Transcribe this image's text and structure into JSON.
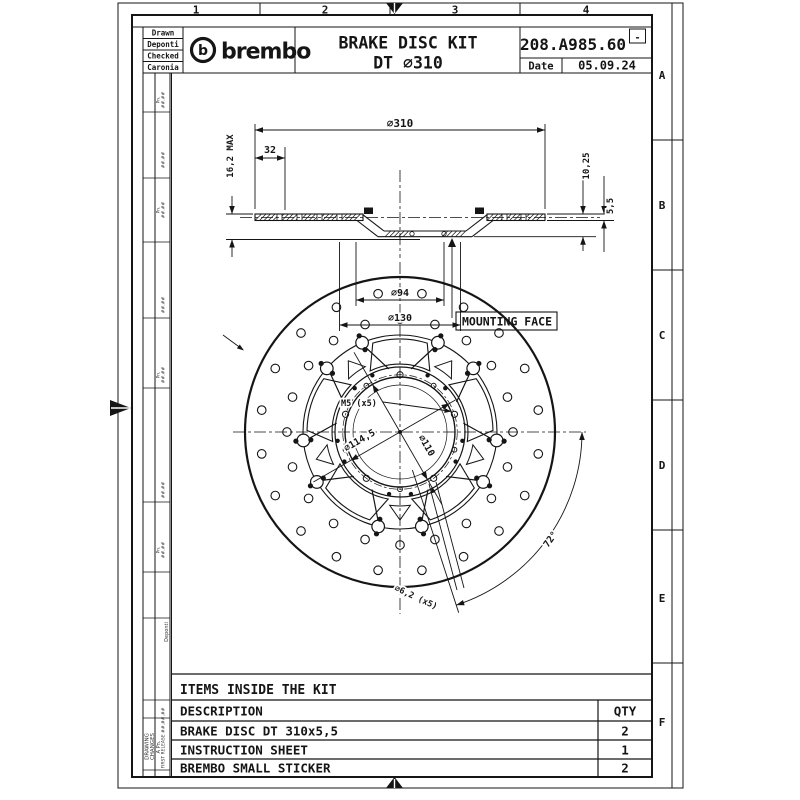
{
  "sheet": {
    "zone_columns": [
      "1",
      "2",
      "3",
      "4"
    ],
    "zone_rows": [
      "A",
      "B",
      "C",
      "D",
      "E",
      "F"
    ]
  },
  "title_block": {
    "role_cells": [
      "Drawn",
      "Deponti",
      "Checked",
      "Caronia"
    ],
    "logo_b": "b",
    "logo_text": "brembo",
    "title_line1": "BRAKE DISC KIT",
    "title_line2": "DT ∅310",
    "part_number": "208.A985.60",
    "revision_mark": "-",
    "date_label": "Date",
    "date_value": "05.09.24"
  },
  "revision_strip": {
    "side_label_line1": "DRAWING",
    "side_label_line2": "CHANGES",
    "revision_row": "A Pn.",
    "first_release": "FIRST RELEASE ##.##.##",
    "author": "Deponti",
    "placeholder_marker": "Pn.",
    "placeholder_date": "##.##"
  },
  "section_view": {
    "dim_outer_diameter": "∅310",
    "dim_band_width": "32",
    "dim_max_thickness": "16,2 MAX",
    "dim_offset": "10,25",
    "dim_disc_thickness": "5,5",
    "dim_inner_diameter": "∅94",
    "dim_hub_diameter": "∅130",
    "mounting_face_label": "MOUNTING FACE"
  },
  "front_view": {
    "dim_small_holes": "M5 (x5)",
    "dim_bolt_circle": "∅114,5",
    "dim_center_bore": "∅110",
    "dim_mount_holes": "∅6,2 (x5)",
    "dim_hole_angle": "72°"
  },
  "kit_table": {
    "header": "ITEMS INSIDE THE KIT",
    "description_header": "DESCRIPTION",
    "qty_header": "QTY",
    "rows": [
      {
        "description": "BRAKE DISC DT 310x5,5",
        "qty": "2"
      },
      {
        "description": "INSTRUCTION SHEET",
        "qty": "1"
      },
      {
        "description": "BREMBO SMALL STICKER",
        "qty": "2"
      }
    ]
  }
}
